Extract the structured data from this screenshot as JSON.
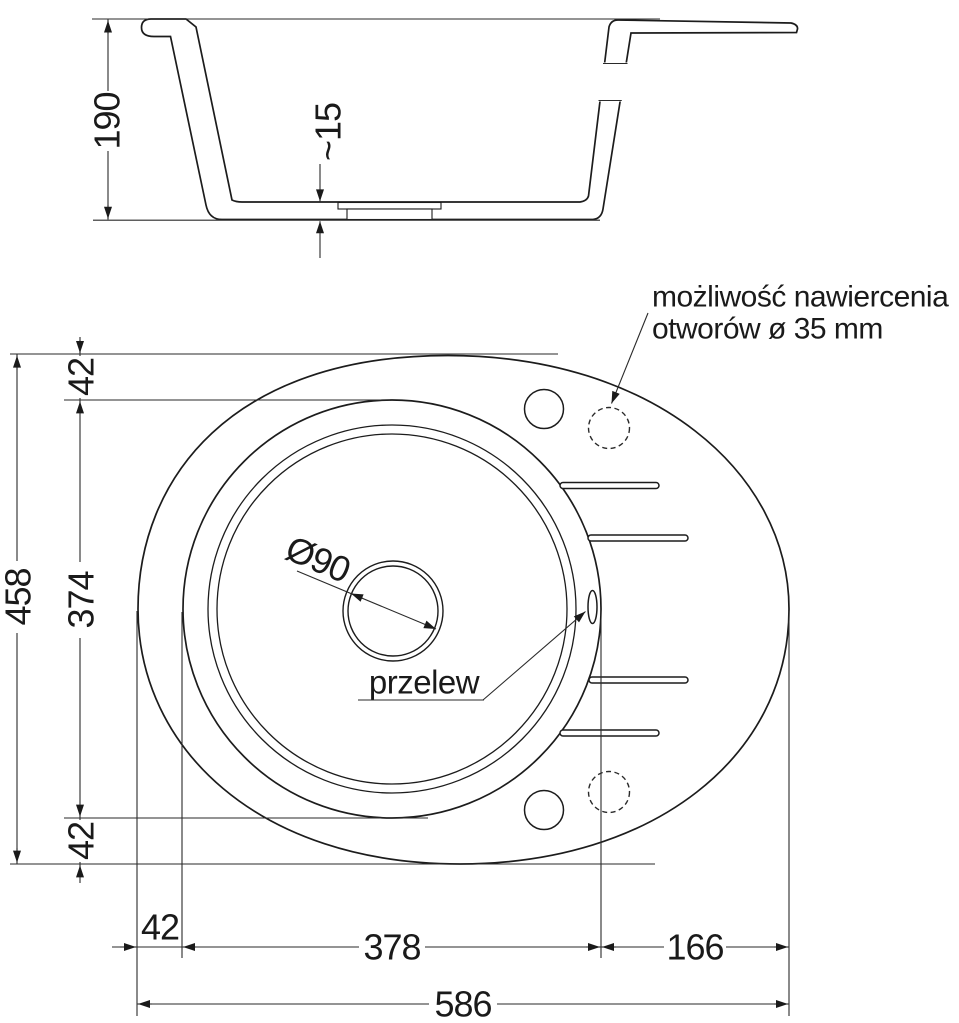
{
  "section": {
    "depth": "190",
    "bottom_thickness": "~15"
  },
  "plan": {
    "total_depth": "458",
    "top_offset": "42",
    "bowl_depth": "374",
    "bottom_offset": "42",
    "left_offset": "42",
    "bowl_width": "378",
    "right_width": "166",
    "total_width": "586",
    "drain_diameter": "Ø90",
    "overflow_label": "przelew",
    "drill_note_line1": "możliwość nawiercenia",
    "drill_note_line2": "otworów ø 35 mm"
  }
}
